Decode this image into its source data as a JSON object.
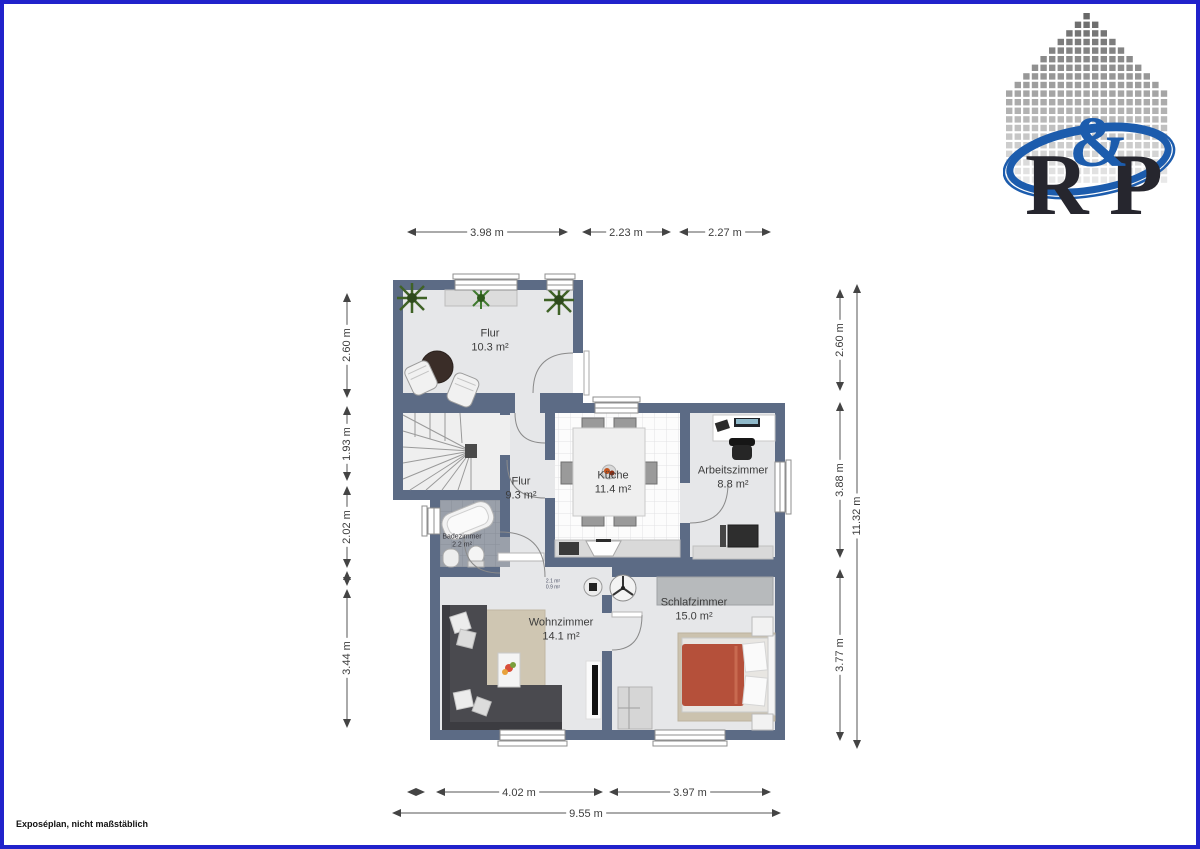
{
  "page": {
    "footer_note": "Exposéplan, nicht maßstäblich"
  },
  "logo": {
    "letter_r": "R",
    "letter_amp": "&",
    "letter_p": "P"
  },
  "plan": {
    "rooms": {
      "flur_top": {
        "name": "Flur",
        "area": "10.3 m²"
      },
      "flur_mid": {
        "name": "Flur",
        "area": "9.3 m²"
      },
      "kueche": {
        "name": "Küche",
        "area": "11.4 m²"
      },
      "arbeitszimmer": {
        "name": "Arbeitszimmer",
        "area": "8.8 m²"
      },
      "badezimmer": {
        "name": "Badezimmer",
        "area": "2.2 m²"
      },
      "wohnzimmer": {
        "name": "Wohnzimmer",
        "area": "14.1 m²"
      },
      "schlafzimmer": {
        "name": "Schlafzimmer",
        "area": "15.0 m²"
      },
      "vestibule": {
        "line1": "2.1 m²",
        "line2": "0.9 m²"
      }
    },
    "dimensions": {
      "top": [
        "3.98 m",
        "2.23 m",
        "2.27 m"
      ],
      "left": [
        "2.60 m",
        "1.93 m",
        "2.02 m",
        "3.44 m"
      ],
      "right": [
        "2.60 m",
        "3.88 m",
        "3.77 m"
      ],
      "right_total": "11.32 m",
      "bottom": [
        "4.02 m",
        "3.97 m"
      ],
      "bottom_total": "9.55 m"
    }
  },
  "colors": {
    "frame_border": "#2122cb",
    "wall": "#5c6b85",
    "floor": "#e6e7e9",
    "bath_tile": "#9aa0aa",
    "bed_blanket": "#b5503a",
    "logo_blue": "#1c5cad"
  }
}
